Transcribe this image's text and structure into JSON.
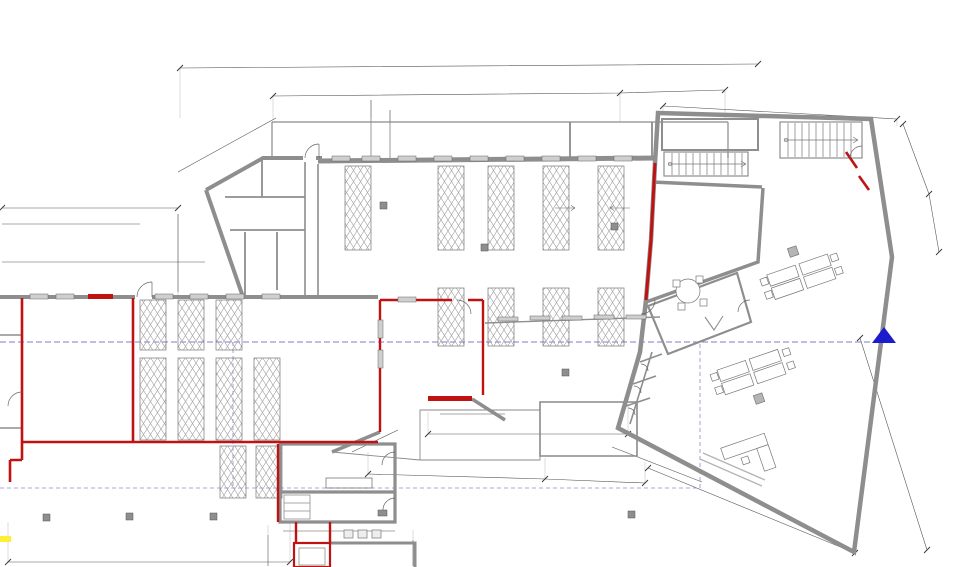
{
  "title": "Grundriss Erdgeschoss",
  "colors": {
    "wall_gray": "#8e8e8e",
    "fire_red": "#c11212",
    "section_blue": "#7d7dd0",
    "schnitt_blue": "#1c1ccc",
    "highlight_yellow": "#ffee33"
  },
  "rooms": {
    "lager": "Lagerfläche\n387,9m²",
    "buero1": "Büro I\n46,8m²",
    "tressen": "Tressen h=  1,1 m\n46,0m²",
    "buero2": "Büro II\n52,62m²",
    "umkleide_damen": "Umkleide\nDamen\nF=21,3m²",
    "flur_eg": "Flur\n6,1m²",
    "flur2": "Flur 7,5m²",
    "wc_damen": "WC-Damen\n3,5m²",
    "wc_herren": "WC-Herrn\n4,1m²",
    "personal": "Personal\n17,0m²",
    "umkleide_d": "Umkleide D\n5,6m²",
    "umkleide_h": "Umkleide H\n5,6m²",
    "ueberdachung33": "Überdachung\n33,1m²",
    "windfang15": "Windfang\n15,7m²",
    "aufzugsschacht": "Aufzugsschacht",
    "abstell_spielothek": "Abstellraum Spielothek\n26,79m²",
    "abstellraum23": "Abstellraum\n23,90m²",
    "besprechung": "Besprechung\n29,65m²",
    "buero_gross": "Büro\n157,99m²",
    "elektro": "Elektroraum\n17,54m²",
    "technik": "Technik + Heizung\n16,69m²",
    "ueberdachung29": "Überdachung\n29,2m²",
    "windfang18": "Windfang\n18,4m²",
    "abst2": "Abst.\n2,16m²",
    "wcd": "WC-D\n4,87m²",
    "wch": "WC-H\n4,96m²",
    "aufzug": "Aufzug\n3,8m²",
    "hausanschluss": "Hausanschlussraum\n7,6 m²"
  },
  "annotations": {
    "notausgang_top": "Notausgang",
    "notausgang_left": "Notausgang",
    "brh_a": "BRH+1,0m",
    "brh_b": "BRH+1,0m",
    "brh_c": "BRH+1,0m",
    "f90_left": "F90",
    "f90_bottom": "F90",
    "f90_elektro": "F90",
    "schnitt": "Schnitt  A",
    "strom_rv": "Strom  RV",
    "meters": "Strom  Wasser  Gas",
    "door1a": "1",
    "door1b": "1",
    "door05": "05"
  },
  "dims": {
    "d2590": "25.90",
    "d1000": "10.00",
    "d500": "5.00",
    "d1652": "16.52",
    "d490": "4.90",
    "d437": "4.37",
    "d338": "3.38",
    "d2176": "21.76",
    "d700": "7.00",
    "d012a": "0.12⁵",
    "d228": "2.28",
    "d012b": "0.12⁵",
    "d564": "5.64⁵",
    "d010a": "0.10",
    "d006": "0.06",
    "d100": "1.00",
    "d169": "1.69",
    "d170a": "1.70",
    "d059": "0.59",
    "d170b": "1.70",
    "d121": "1.21⁵",
    "d090": "0.90",
    "d017a": "0.17⁵",
    "d150a": "1.50",
    "d017b": "0.17⁵",
    "d016": "0.16",
    "d150b": "1.50",
    "d518": "5.18",
    "d266": "2.66",
    "d1865": "18.65",
    "d1913": "19.13⁵",
    "d024a": "0.24",
    "d110a": "1.10",
    "d210": "2.10",
    "d176": "1.76",
    "d123a": "1.23⁵",
    "d180a": "1.80",
    "d415": "4.15",
    "d1398": "13.98",
    "d1044": "10.44⁵",
    "d621": "6.21",
    "d029": "0.29⁵",
    "d014a": "0.14⁵",
    "d014b": "0.14⁵",
    "d010b": "0.10",
    "d113": "1.13⁵",
    "d110b": "1.10",
    "d123b": "1.23⁵",
    "d1258": "12.58",
    "d842": "8.42⁵",
    "d012c": "0.12⁵",
    "d115": "1.15",
    "d024b": "0.24",
    "d180b": "1.80",
    "d024c": "0.24",
    "d326": "3.26⁵",
    "d017c": "0.17",
    "d024d": "0.24",
    "d078": "0.78⁵",
    "d024e": "0.24",
    "d234": "2.34"
  }
}
